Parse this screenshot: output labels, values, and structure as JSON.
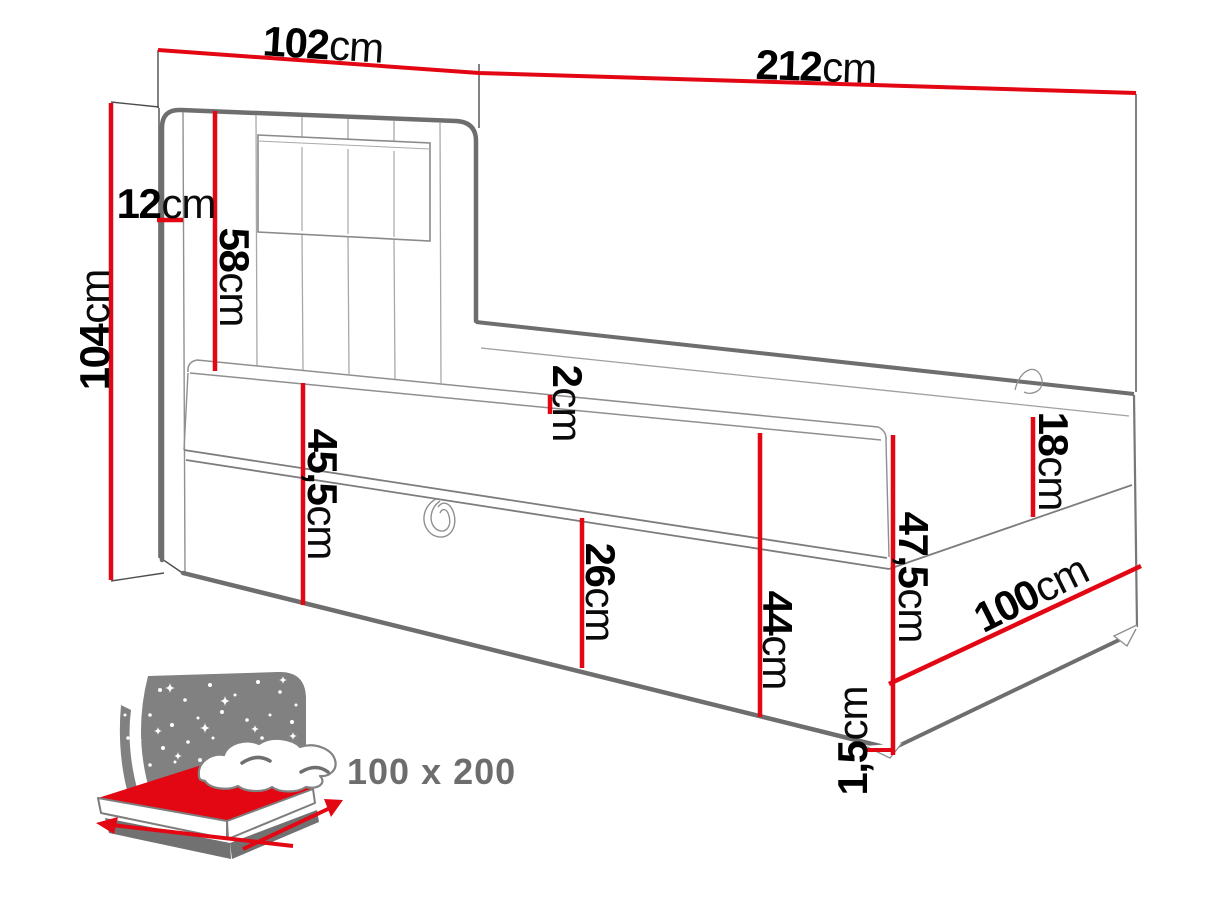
{
  "diagram": {
    "description": "Boxspring bed dimension drawing",
    "unit": "cm",
    "colors": {
      "dimension_red": "#e30613",
      "outline_gray": "#6e6e6e",
      "seam_gray": "#a5a5a5",
      "label_black": "#000000",
      "icon_gray": "#818181",
      "size_text_gray": "#6d6d6d",
      "background": "#ffffff"
    },
    "dimensions": [
      {
        "id": "headboard-width",
        "value": "102",
        "unit": "cm",
        "value_cm": 102
      },
      {
        "id": "bed-length",
        "value": "212",
        "unit": "cm",
        "value_cm": 212
      },
      {
        "id": "headboard-height",
        "value": "104",
        "unit": "cm",
        "value_cm": 104
      },
      {
        "id": "headboard-depth",
        "value": "12",
        "unit": "cm",
        "value_cm": 12
      },
      {
        "id": "headboard-above-mattress",
        "value": "58",
        "unit": "cm",
        "value_cm": 58
      },
      {
        "id": "topper-thickness",
        "value": "2",
        "unit": "cm",
        "value_cm": 2
      },
      {
        "id": "side-height-to-floor",
        "value": "45,5",
        "unit": "cm",
        "value_cm": 45.5
      },
      {
        "id": "drawer-front-height",
        "value": "26",
        "unit": "cm",
        "value_cm": 26
      },
      {
        "id": "side-height",
        "value": "44",
        "unit": "cm",
        "value_cm": 44
      },
      {
        "id": "mattress-height",
        "value": "18",
        "unit": "cm",
        "value_cm": 18
      },
      {
        "id": "foot-end-total-height",
        "value": "47,5",
        "unit": "cm",
        "value_cm": 47.5
      },
      {
        "id": "bed-width",
        "value": "100",
        "unit": "cm",
        "value_cm": 100
      },
      {
        "id": "floor-clearance",
        "value": "1,5",
        "unit": "cm",
        "value_cm": 1.5
      }
    ],
    "size_badge": {
      "text": "100 x 200"
    }
  }
}
